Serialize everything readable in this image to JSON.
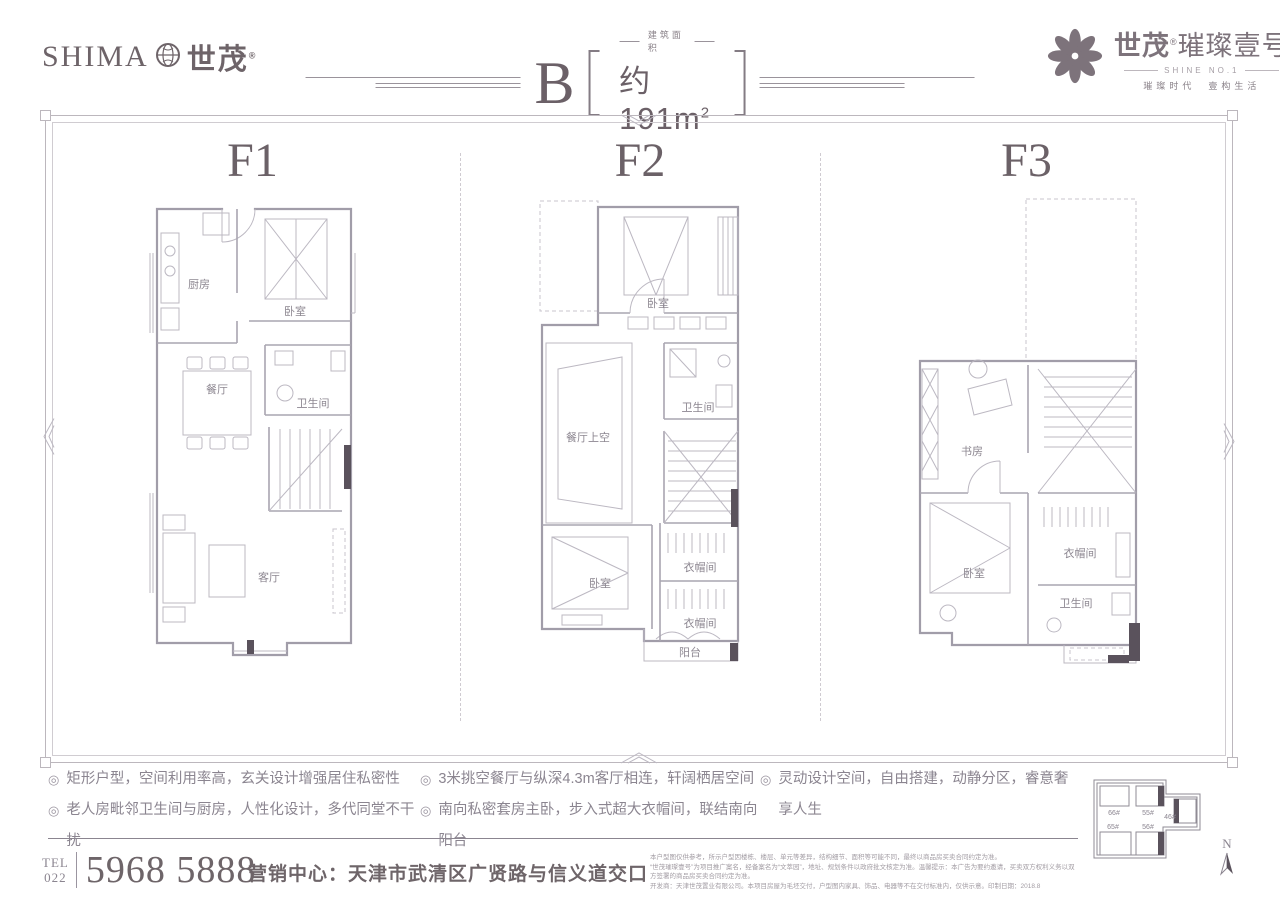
{
  "header": {
    "brand_left": {
      "en": "SHIMA",
      "globe_icon": "globe",
      "cn": "世茂",
      "reg": "®"
    },
    "title": {
      "letter": "B",
      "area_label": "建筑面积",
      "area_value": "约191m",
      "area_sup": "2"
    },
    "brand_right": {
      "flower_icon": "flower",
      "cn_bold": "世茂",
      "reg": "®",
      "cn_rest": "璀璨壹号",
      "en": "SHINE NO.1",
      "tagline": "璀璨时代　壹构生活"
    }
  },
  "floors": [
    {
      "label": "F1",
      "rooms": [
        "厨房",
        "卧室",
        "卫生间",
        "餐厅",
        "客厅"
      ]
    },
    {
      "label": "F2",
      "rooms": [
        "卧室",
        "卫生间",
        "餐厅上空",
        "卧室",
        "衣帽间",
        "衣帽间",
        "阳台"
      ]
    },
    {
      "label": "F3",
      "rooms": [
        "书房",
        "卧室",
        "衣帽间",
        "卫生间"
      ]
    }
  ],
  "features": {
    "bullet": "◎",
    "col1": [
      "矩形户型，空间利用率高，玄关设计增强居住私密性",
      "老人房毗邻卫生间与厨房，人性化设计，多代同堂不干扰"
    ],
    "col2": [
      "3米挑空餐厅与纵深4.3m客厅相连，轩阔栖居空间",
      "南向私密套房主卧，步入式超大衣帽间，联结南向阳台"
    ],
    "col3": [
      "灵动设计空间，自由搭建，动静分区，睿意奢享人生"
    ]
  },
  "footer": {
    "tel_label": "TEL",
    "tel_area": "022",
    "tel_number": "5968 5888",
    "address": "营销中心：天津市武清区广贤路与信义道交口",
    "disclaimer": [
      "本户型图仅供参考，所示户型因楼栋、楼层、单元等差异，结构细节、面积等可能不同，最终以商品房买卖合同约定为准。",
      "“世茂璀璨壹号”为项目推广案名，经备案名为“文萃园”，地址、规划条件以政府批文核定为准。温馨提示：本广告为要约邀请，买卖双方权利义务以双方签署的商品房买卖合同约定为准。",
      "开发商：天津世茂置业有限公司。本项目房屋为毛坯交付，户型图内家具、饰品、电器等不在交付标准内，仅供示意。印制日期：2018.8"
    ]
  },
  "keyplan": {
    "buildings": [
      "66#",
      "55#",
      "46#",
      "65#",
      "56#"
    ],
    "compass": "N"
  }
}
